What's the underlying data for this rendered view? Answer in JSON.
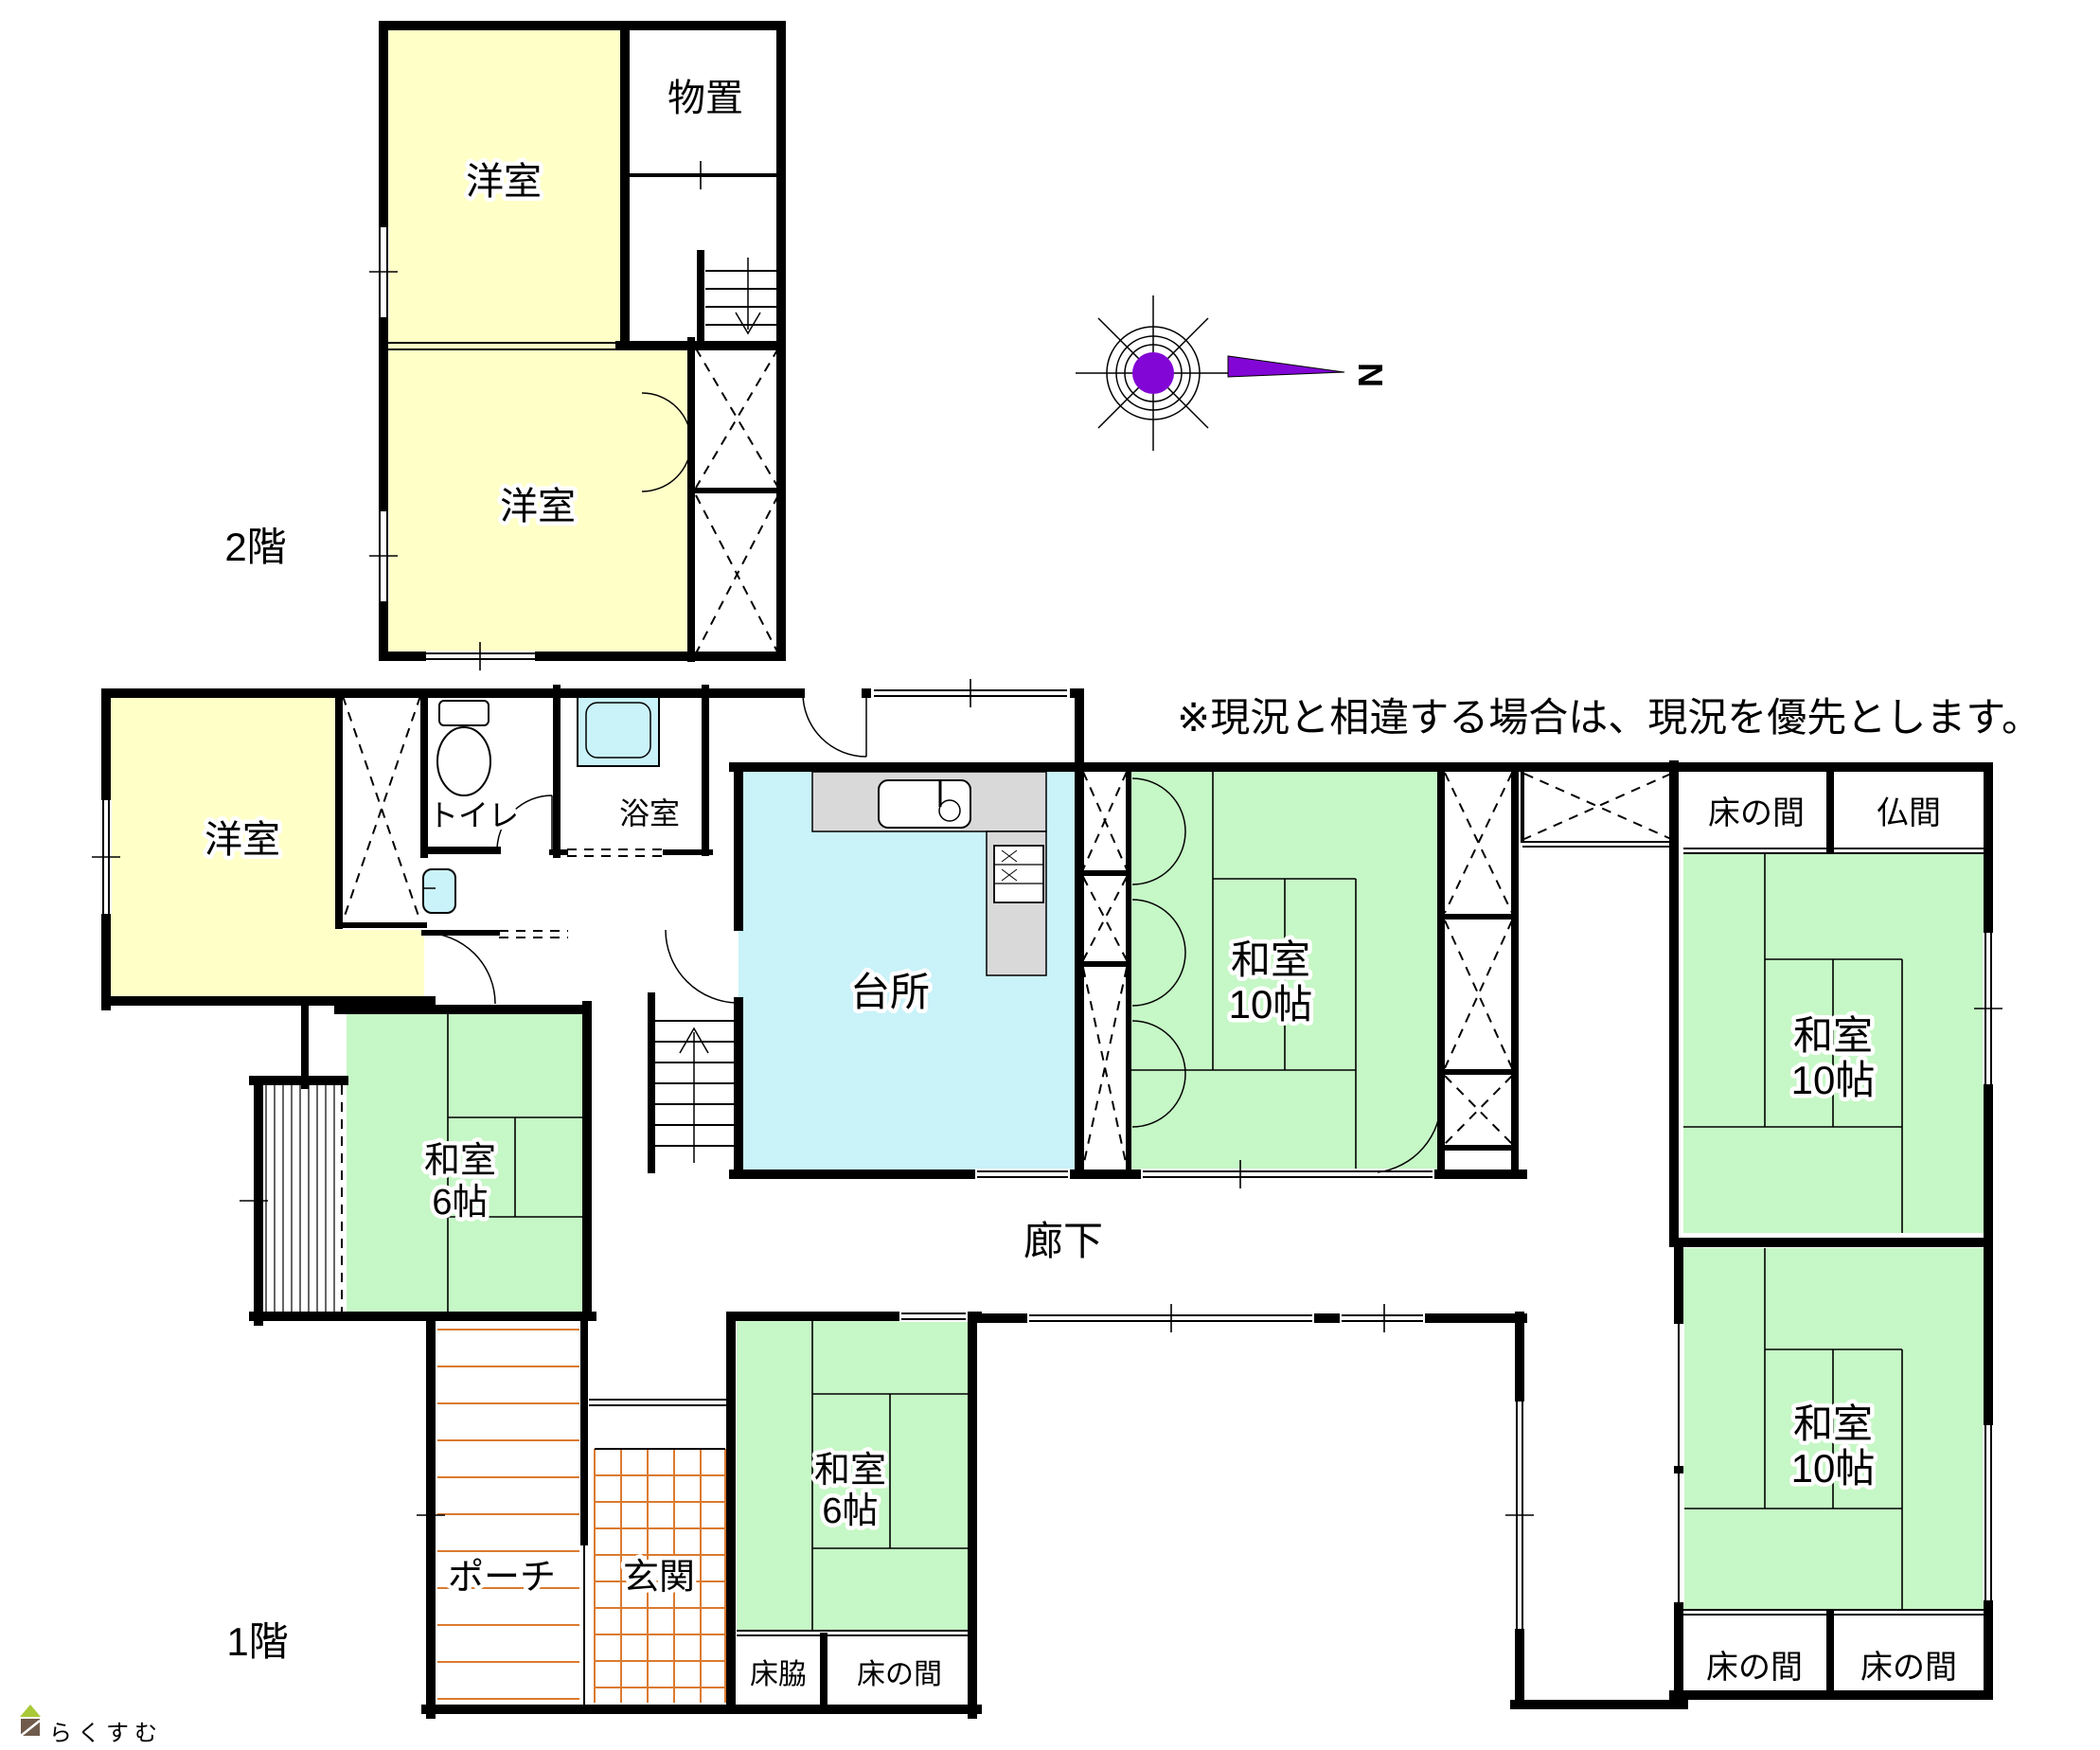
{
  "palette": {
    "wall": "#000000",
    "room_yellow": "#FFFFC8",
    "room_green": "#C6F7C6",
    "room_cyan": "#C9F2F9",
    "counter_gray": "#D9D9D9",
    "compass_purple": "#8206D6",
    "tile_orange": "#DB7A2E",
    "logo_brown": "#6F5A4B",
    "logo_green": "#A9C938",
    "logo_text": "#7A6456"
  },
  "floor2": {
    "label": "2階",
    "rooms": {
      "western_top": "洋室",
      "storage": "物置",
      "western_bottom": "洋室"
    }
  },
  "floor1": {
    "label": "1階",
    "rooms": {
      "western": "洋室",
      "toilet": "トイレ",
      "bath": "浴室",
      "kitchen": "台所",
      "washitsu_center": {
        "name": "和室",
        "size": "10帖"
      },
      "tokonoma_ne": "床の間",
      "butsuma": "仏間",
      "washitsu_east_upper": {
        "name": "和室",
        "size": "10帖"
      },
      "washitsu_east_lower": {
        "name": "和室",
        "size": "10帖"
      },
      "washitsu_west": {
        "name": "和室",
        "size": "6帖"
      },
      "washitsu_south": {
        "name": "和室",
        "size": "6帖"
      },
      "corridor": "廊下",
      "porch": "ポーチ",
      "entrance": "玄関",
      "tokowaki": "床脇",
      "tokonoma_s": "床の間",
      "tokonoma_sw": "床の間",
      "tokonoma_se": "床の間"
    }
  },
  "annotation": "※現況と相違する場合は、現況を優先とします。",
  "compass": {
    "north_label": "N"
  },
  "logo": {
    "text": "らくすむ"
  }
}
